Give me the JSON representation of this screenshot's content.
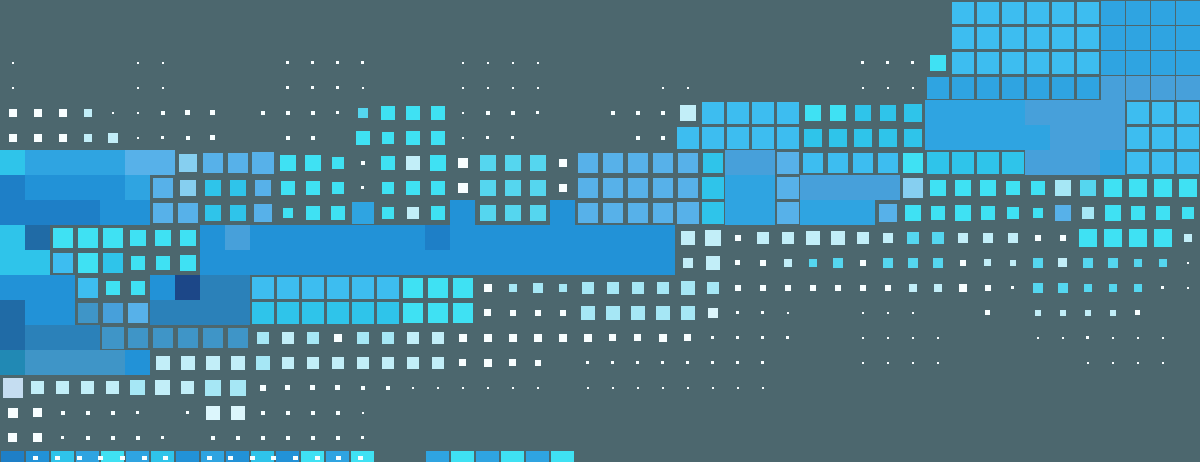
{
  "canvas": {
    "width": 1200,
    "height": 462,
    "background": "#4c676e",
    "cell_pitch": 25,
    "columns": 48,
    "rows": 18
  },
  "palette": {
    "W": "#f8feff",
    "p": "#dcf6fc",
    "P": "#c2eef8",
    "L": "#a6e7f5",
    "V": "#c5ddf1",
    "E": "#86cff0",
    "C": "#3fe1f3",
    "c": "#55d6ef",
    "T": "#2fc4ea",
    "B": "#3dbdf0",
    "A": "#57b1e9",
    "b": "#2fa4e1",
    "M": "#2292d7",
    "D": "#1e7fc7",
    "G": "#47a0da",
    "S": "#3f95c7",
    "s": "#2b81b9",
    "K": "#206ba6",
    "t": "#2189b4",
    "N": "#1c4788"
  },
  "grid_rows": [
    ". . . . . . . . . . . . . . . . . . . . . . . . . . . . . . . . . . . . . . 22B 22B 22B 22B 22B 22B 24b 24b 24b 24b",
    ". . . . . . . . . . . . . . . . . . . . . . . . . . . . . . . . . . . . . . 22B 22B 22B 22B 22B 22B 24b 24b 24b 24b",
    "2W . . . . 2W 2W . . . . 3W 3W 3W 3W . . . 2W 2W 2W 2W . . . . . . . . . . . . 3W 3W 3W 16C 22B 22B 22B 22B 22B 22B 24b 24b 24b 24b",
    "2W . . . . 2W 2W . . . . 3W 3W 3W 2W . . . 2W 2W 2W 2W . . . . 2W 2W . . . . . . 2W 2W 2W 22b 22b 22b 22b 22b 22b 22b 24G 24G 24G 24G",
    "8W 8W 8W 8P 2W 2W 4W 5W 5W . 4W 4W 4W 3W 10c 14C 14C 14C 2W 4W 4W 3W . . 4W 4W 4W 16P 22B 22B 22B 22B 16C 16C 16T 16T 18T 25b 25b 25b 25b 25G 25G 25G 25G 22B 22B 22B",
    "8W 8W 8W 8P 10P 2W 3W 4W 5W . . 4W 4W . 14C 12C 14C 14C 2W 3W 3W . . . . 4W 4W 22B 22B 22B 22B 22B 18T 18T 18T 18T 18T 25b 25b 25b 25b 25b 25G 25G 25G 22B 22B 22B",
    "25T 25b 25b 25b 25b 25A 25A 18E 20A 20A 22A 16C 16C 12C 4W 14C 14P 16C 10W 16c 16c 16c 8W 20A 20A 20A 20A 20A 20T 25G 25G 22A 20B 20B 20B 20B 20C 22T 22T 22T 22T 25G 25G 25G 25b 22B 22B 22B",
    "25D 25M 25M 25M 25M 25b 20A 16E 16T 16T 16A 14C 14C 12C 3W 12C 14C 14C 10W 16c 16c 16c 8W 20A 20A 20A 20A 20A 22T 25b 25b 22A 25G 25G 25G 25G 20E 16C 16C 16C 14C 14C 16L 16c 18C 18C 18C 18C",
    "25D 25D 25D 25D 25M 25M 20A 20A 16T 16T 18A 10C 14C 14C 22b 12C 12P 14C 25M 16c 16c 16c 25M 20A 20A 20A 20A 22A 22T 25b 25b 22A 25b 25b 25b 18A 16C 14C 16C 14C 12C 10C 16A 12L 16C 14C 14C 12C",
    "25T 25K 20C 20C 20C 16C 16C 16C 25M 25G 25M 25M 25M 25M 25M 25M 25M 25D 25M 25M 25M 25M 25M 25M 25M 25M 25M 14P 16P 6W 12P 12P 14P 14P 12P 10P 12c 12c 10P 10P 10P 6W 6W 18C 18C 18C 18C 8P",
    "25T 25T 20B 20C 20T 14C 14C 16C 25M 25M 25M 25M 25M 25M 25M 25M 25M 25M 25M 25M 25M 25M 25M 25M 25M 25M 25M 10P 14P 5W 6W 8P 8c 10c 6W 10c 10c 10c 6W 7P 6P 10c 9P 10c 10c 8c 8c 2W",
    "25M 25M 25M 20B 14C 14C 25M 25N 25s 25s 22B 22B 22B 22B 22B 22B 20C 20C 20C 8W 8L 10L 8L 12L 12L 12L 12L 14L 12L 6W 6W 6W 6W 6W 6W 6W 8P 8P 8W 6W 3W 10c 10c 8c 8c 8c 3W 2W",
    "25K 25M 25M 20S 20G 20A 25s 25s 25s 25s 22T 22T 22T 22T 22T 22T 20C 20C 20C 7W 6W 6W 6W 14L 14L 14L 14L 14L 10p 3W 3W 2W . . 2W 2W 2W . . 5W . 6P 6P 6P 6P 5W . .",
    "25K 25s 25s 25s 22S 20S 20S 20S 20S 20S 12L 12P 12L 8W 12L 12L 12P 12P 8W 8W 8W 8W 8W 8W 7W 7W 8W 7W 3W 3W 3W 3W . . 2W 2W 2W 2W . . . 2W 2W 3W 2W 2W 2W .",
    "25t 25S 25S 25S 25S 25M 14P 14P 14P 14P 14L 12P 12P 12P 12P 12P 12P 12P 7W 8W 7W 6W . 3W 3W 3W 3W 3W 3W 3W 3W . . . 2W 2W 2W 2W . . . . . 2W 2W 2W 2W .",
    "20V 13P 13P 13P 13P 15L 15P 13P 16L 16L 6W 5W 5W 5W 4W 4W 2W 2W 2W 2W 2W 2W . 2W 2W 2W 2W 2W 2W 2W 2W . . . . . . . . . . . . . . . . .",
    "10W 9W 4W 4W 4W 3W . 3W 14p 14p 4W 4W 4W 4W 2W . . . . . . . . . . . . . . . . . . . . . . . . . . . . . . . . .",
    "9W 9W 3W 4W 4W 4W 3W . 4W 4W 4W 4W 4W 4W 3W . . . . . . . . . . . . . . . . . . . . . . . . . . . . . . . . ."
  ],
  "bottom_row": {
    "y": 451,
    "tile_width": 23,
    "tile_height": 11,
    "tiles": [
      {
        "col": 0,
        "color": "D"
      },
      {
        "col": 1,
        "color": "M"
      },
      {
        "col": 2,
        "color": "T"
      },
      {
        "col": 3,
        "color": "b"
      },
      {
        "col": 4,
        "color": "C"
      },
      {
        "col": 5,
        "color": "b"
      },
      {
        "col": 6,
        "color": "T"
      },
      {
        "col": 7,
        "color": "M"
      },
      {
        "col": 8,
        "color": "b"
      },
      {
        "col": 9,
        "color": "M"
      },
      {
        "col": 10,
        "color": "T"
      },
      {
        "col": 11,
        "color": "M"
      },
      {
        "col": 12,
        "color": "C"
      },
      {
        "col": 13,
        "color": "b"
      },
      {
        "col": 14,
        "color": "C"
      },
      {
        "col": 17,
        "color": "b"
      },
      {
        "col": 18,
        "color": "C"
      },
      {
        "col": 19,
        "color": "b"
      },
      {
        "col": 20,
        "color": "C"
      },
      {
        "col": 21,
        "color": "b"
      },
      {
        "col": 22,
        "color": "C"
      }
    ]
  },
  "bottom_ticks": {
    "y": 456,
    "width": 5,
    "height": 4,
    "color": "W",
    "x_positions": [
      33,
      55,
      77,
      98,
      120,
      142,
      163,
      207,
      228,
      250,
      271,
      293,
      315,
      336,
      358
    ]
  }
}
